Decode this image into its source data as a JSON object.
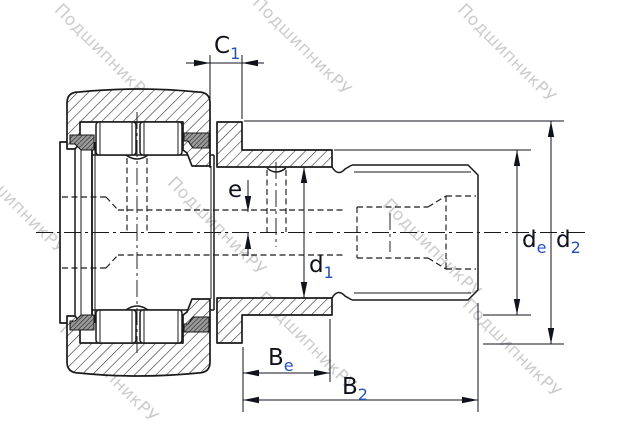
{
  "drawing": {
    "type": "bearing-cross-section",
    "description": "Stud-type track roller cam follower with eccentric collar, sectional technical drawing"
  },
  "watermark": {
    "text": "ПодшипникРУ"
  },
  "labels": {
    "c1": {
      "main": "C",
      "sub": "1"
    },
    "e": {
      "main": "e"
    },
    "d1": {
      "main": "d",
      "sub": "1"
    },
    "de": {
      "main": "d",
      "sub": "e"
    },
    "d2": {
      "main": "d",
      "sub": "2"
    },
    "be": {
      "main": "B",
      "sub": "e"
    },
    "b2": {
      "main": "B",
      "sub": "2"
    }
  },
  "colors": {
    "ink": "#1a1a1a",
    "dim": "#10131c",
    "sub": "#2450bd",
    "wm": "#a9a9a9",
    "bg": "#ffffff"
  }
}
